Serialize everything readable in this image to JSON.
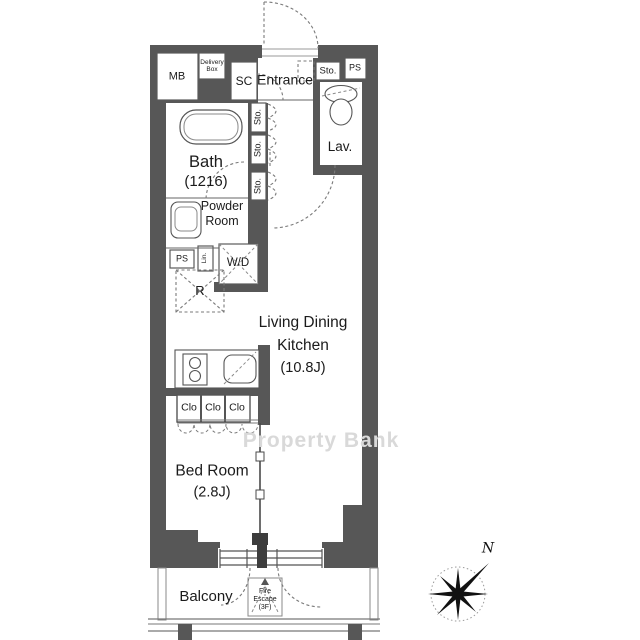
{
  "colors": {
    "wall": "#575757",
    "line": "#4f4f4f",
    "dashed": "#7a7a7a",
    "text": "#1b1b1b",
    "watermark": "#d9d9d9"
  },
  "watermark": "Property Bank",
  "compass": {
    "north": "N"
  },
  "top": {
    "mailbox": "MB",
    "delivery_box_line1": "Delivery",
    "delivery_box_line2": "Box",
    "shoe_closet": "SC",
    "entrance": "Entrance",
    "storage": "Sto.",
    "pipe_space": "PS"
  },
  "wet_area": {
    "lavatory": "Lav.",
    "bath_name": "Bath",
    "bath_size": "(1216)",
    "powder_line1": "Powder",
    "powder_line2": "Room",
    "pipe_space": "PS",
    "linen": "Lin.",
    "washer_dryer": "W/D",
    "refrigerator": "R"
  },
  "hall_storage": [
    "Sto.",
    "Sto.",
    "Sto."
  ],
  "ldk": {
    "line1": "Living Dining",
    "line2": "Kitchen",
    "size": "(10.8J)"
  },
  "closets": [
    "Clo",
    "Clo",
    "Clo"
  ],
  "bedroom": {
    "name": "Bed Room",
    "size": "(2.8J)"
  },
  "balcony": {
    "name": "Balcony",
    "fire_escape_line1": "Fire",
    "fire_escape_line2": "Escape",
    "fire_escape_line3": "(3F)"
  }
}
